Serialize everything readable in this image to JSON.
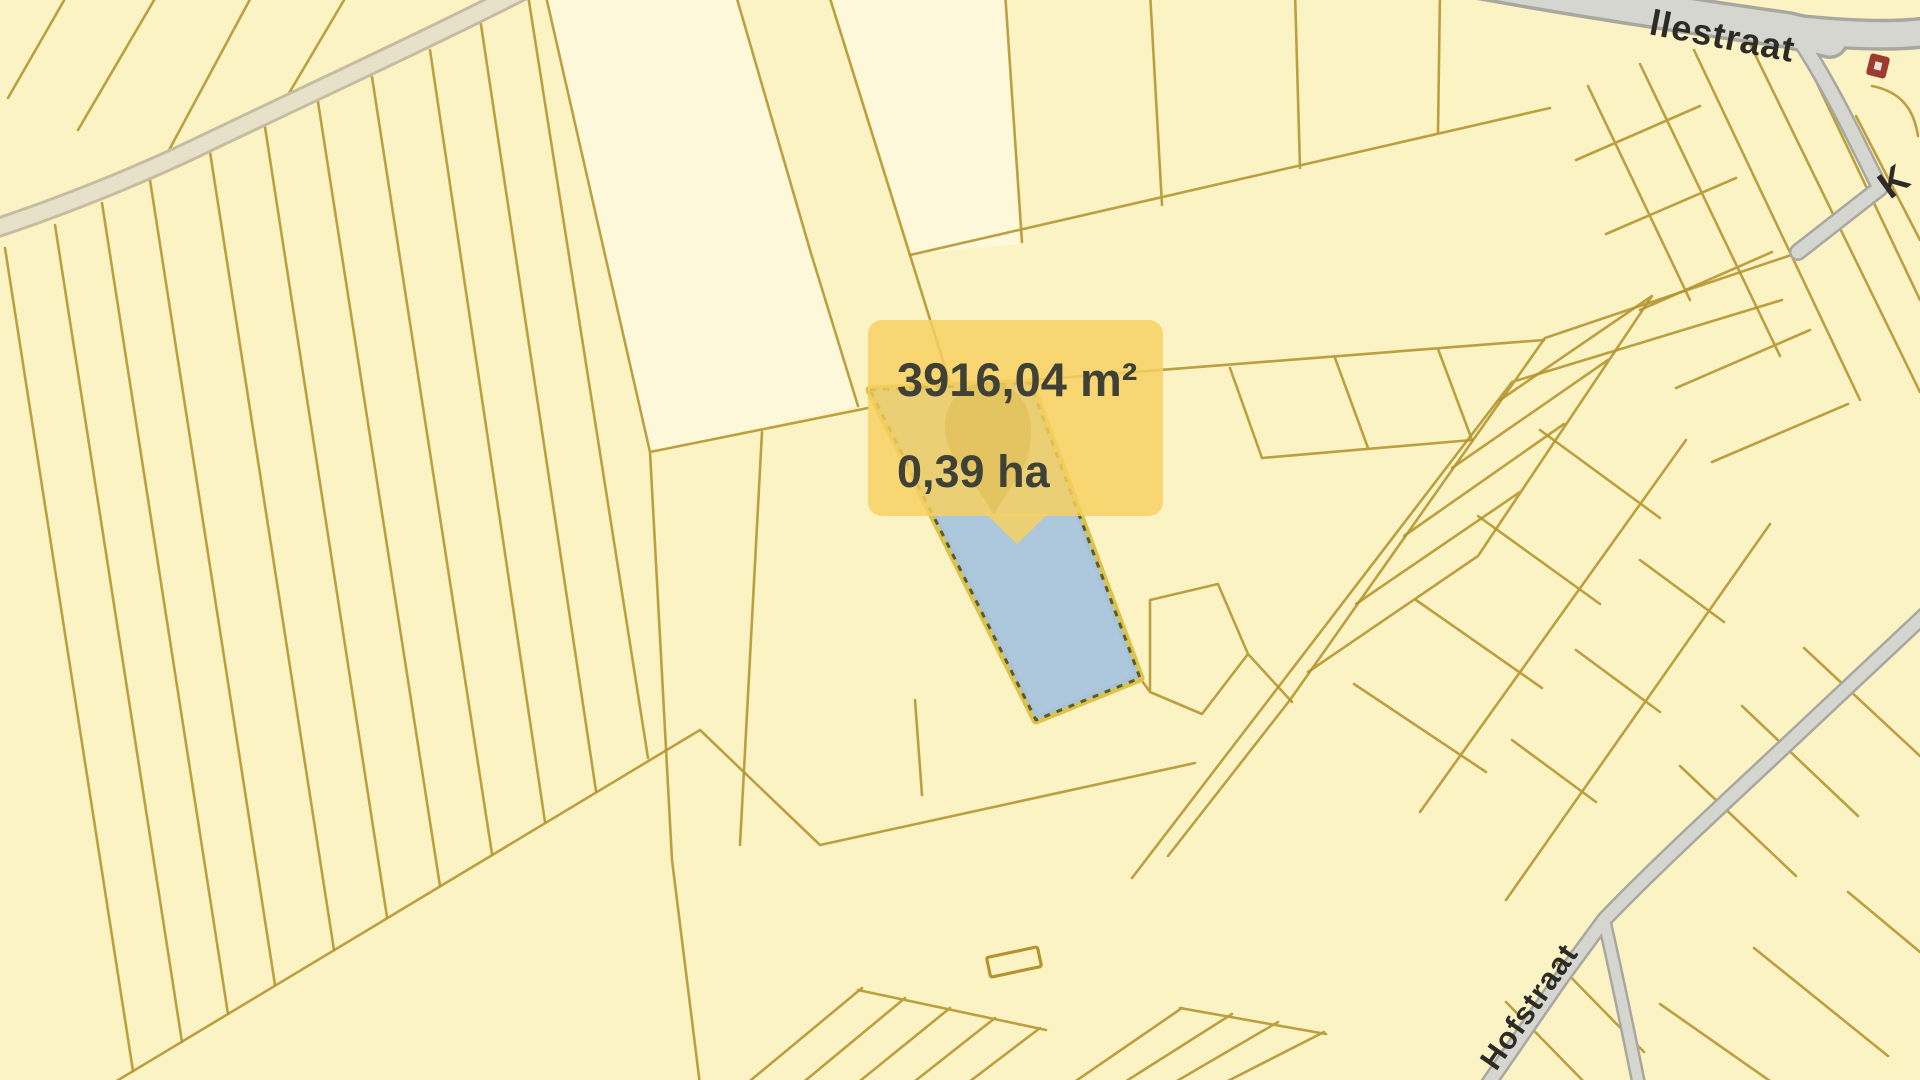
{
  "app": {
    "type": "cadastral-parcel-map-view"
  },
  "tooltip": {
    "area_m2": "3916,04 m²",
    "area_ha": "0,39 ha"
  },
  "streets": {
    "top": "llestraat",
    "bottom": "Hofstraat",
    "right_partial": "K"
  },
  "icons": {
    "marker": "location-pin-icon",
    "poi": "building-poi-icon"
  },
  "colors": {
    "background": "#fcf3c5",
    "parcel_light": "#fdf8da",
    "parcel_line": "#b3942e",
    "road_casing": "#c6bda1",
    "road_fill": "#e8e1c9",
    "gray_road_casing": "#a8a8a1",
    "gray_road_fill": "#d6d6d1",
    "highlight_fill": "rgba(166,195,222,0.92)",
    "highlight_casing": "#dcc34a",
    "highlight_dash": "#5c5c28",
    "tooltip_bg": "rgba(247,209,97,0.84)",
    "tooltip_text": "#3f4036",
    "pin_fill": "rgba(132,126,84,0.95)",
    "street_label": "#2c2b25",
    "poi_red": "#9c3b30",
    "building_line": "#b3942e"
  }
}
